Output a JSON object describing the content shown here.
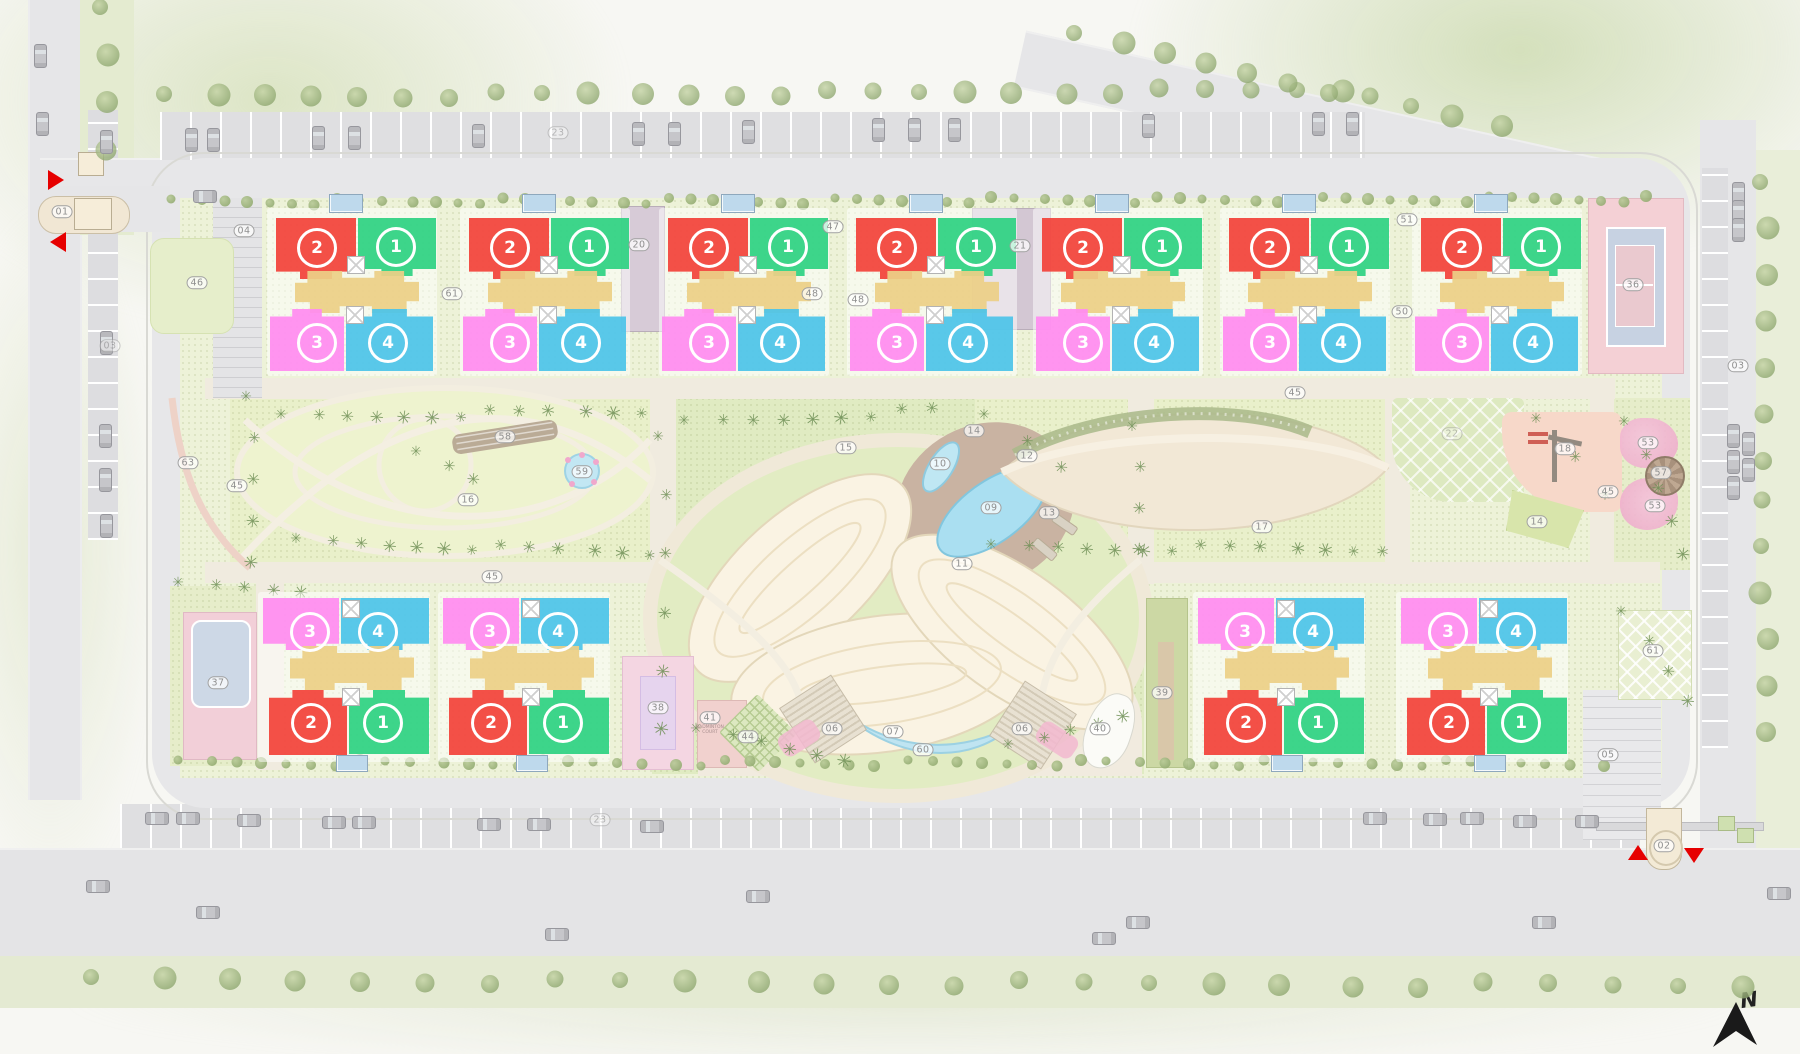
{
  "north": {
    "label": "N"
  },
  "units": {
    "u1": {
      "num": "1",
      "color": "#2ed282"
    },
    "u2": {
      "num": "2",
      "color": "#f2433a"
    },
    "u3": {
      "num": "3",
      "color": "#ff8cf0"
    },
    "u4": {
      "num": "4",
      "color": "#4cc4e8"
    }
  },
  "palette": {
    "tan": "#ecd086",
    "arrow_red": "#e60000"
  },
  "top_clusters": [
    {
      "cx": 317
    },
    {
      "cx": 510
    },
    {
      "cx": 709
    },
    {
      "cx": 897
    },
    {
      "cx": 1083
    },
    {
      "cx": 1270
    },
    {
      "cx": 1462
    }
  ],
  "bottom_clusters": [
    {
      "cx": 310
    },
    {
      "cx": 490
    },
    {
      "cx": 1245
    },
    {
      "cx": 1448
    }
  ],
  "labels": [
    {
      "t": "01",
      "x": 62,
      "y": 212
    },
    {
      "t": "02",
      "x": 1664,
      "y": 846
    },
    {
      "t": "03",
      "x": 110,
      "y": 346,
      "faint": true
    },
    {
      "t": "03",
      "x": 1738,
      "y": 366
    },
    {
      "t": "04",
      "x": 244,
      "y": 231
    },
    {
      "t": "05",
      "x": 1608,
      "y": 755
    },
    {
      "t": "06",
      "x": 832,
      "y": 729
    },
    {
      "t": "06",
      "x": 1022,
      "y": 729
    },
    {
      "t": "07",
      "x": 893,
      "y": 732
    },
    {
      "t": "09",
      "x": 991,
      "y": 508
    },
    {
      "t": "10",
      "x": 940,
      "y": 464
    },
    {
      "t": "11",
      "x": 962,
      "y": 564
    },
    {
      "t": "12",
      "x": 1027,
      "y": 456
    },
    {
      "t": "13",
      "x": 1049,
      "y": 513
    },
    {
      "t": "14",
      "x": 974,
      "y": 431
    },
    {
      "t": "14",
      "x": 1537,
      "y": 522
    },
    {
      "t": "15",
      "x": 846,
      "y": 448
    },
    {
      "t": "16",
      "x": 468,
      "y": 500
    },
    {
      "t": "17",
      "x": 1262,
      "y": 527
    },
    {
      "t": "18",
      "x": 1565,
      "y": 449
    },
    {
      "t": "20",
      "x": 639,
      "y": 245
    },
    {
      "t": "21",
      "x": 1020,
      "y": 246
    },
    {
      "t": "22",
      "x": 1452,
      "y": 434,
      "faint": true
    },
    {
      "t": "23",
      "x": 558,
      "y": 133,
      "faint": true
    },
    {
      "t": "23",
      "x": 600,
      "y": 820,
      "faint": true
    },
    {
      "t": "36",
      "x": 1633,
      "y": 285
    },
    {
      "t": "37",
      "x": 218,
      "y": 683
    },
    {
      "t": "38",
      "x": 658,
      "y": 708
    },
    {
      "t": "39",
      "x": 1162,
      "y": 693
    },
    {
      "t": "40",
      "x": 1100,
      "y": 729
    },
    {
      "t": "41",
      "x": 710,
      "y": 718,
      "cap": "BADMINTON COURT"
    },
    {
      "t": "44",
      "x": 748,
      "y": 737
    },
    {
      "t": "45",
      "x": 237,
      "y": 486
    },
    {
      "t": "45",
      "x": 492,
      "y": 577
    },
    {
      "t": "45",
      "x": 1295,
      "y": 393
    },
    {
      "t": "45",
      "x": 1608,
      "y": 492
    },
    {
      "t": "46",
      "x": 197,
      "y": 283
    },
    {
      "t": "47",
      "x": 833,
      "y": 227
    },
    {
      "t": "48",
      "x": 812,
      "y": 294
    },
    {
      "t": "48",
      "x": 858,
      "y": 300
    },
    {
      "t": "50",
      "x": 1402,
      "y": 312
    },
    {
      "t": "51",
      "x": 1407,
      "y": 220
    },
    {
      "t": "53",
      "x": 1648,
      "y": 443
    },
    {
      "t": "53",
      "x": 1655,
      "y": 506
    },
    {
      "t": "57",
      "x": 1661,
      "y": 473
    },
    {
      "t": "58",
      "x": 505,
      "y": 437
    },
    {
      "t": "59",
      "x": 582,
      "y": 472
    },
    {
      "t": "60",
      "x": 923,
      "y": 750
    },
    {
      "t": "61",
      "x": 452,
      "y": 294
    },
    {
      "t": "61",
      "x": 1653,
      "y": 651
    },
    {
      "t": "63",
      "x": 188,
      "y": 463
    }
  ],
  "entrance_arrows": [
    {
      "dir": "right",
      "x": 48,
      "y": 170
    },
    {
      "dir": "left",
      "x": 50,
      "y": 232
    },
    {
      "dir": "up",
      "x": 1628,
      "y": 845
    },
    {
      "dir": "down",
      "x": 1684,
      "y": 848
    }
  ],
  "cars": [
    [
      185,
      128,
      "v"
    ],
    [
      207,
      128,
      "v"
    ],
    [
      312,
      126,
      "v"
    ],
    [
      348,
      126,
      "v"
    ],
    [
      472,
      124,
      "v"
    ],
    [
      632,
      122,
      "v"
    ],
    [
      668,
      122,
      "v"
    ],
    [
      742,
      120,
      "v"
    ],
    [
      872,
      118,
      "v"
    ],
    [
      908,
      118,
      "v"
    ],
    [
      948,
      118,
      "v"
    ],
    [
      1142,
      114,
      "v"
    ],
    [
      1312,
      112,
      "v"
    ],
    [
      1346,
      112,
      "v"
    ],
    [
      34,
      44,
      "v"
    ],
    [
      36,
      112,
      "v"
    ],
    [
      100,
      130,
      "v"
    ],
    [
      100,
      331,
      "v"
    ],
    [
      99,
      424,
      "v"
    ],
    [
      99,
      468,
      "v"
    ],
    [
      100,
      514,
      "v"
    ],
    [
      1732,
      182,
      "v"
    ],
    [
      1732,
      200,
      "v"
    ],
    [
      1732,
      218,
      "v"
    ],
    [
      1727,
      424,
      "v"
    ],
    [
      1727,
      450,
      "v"
    ],
    [
      1742,
      432,
      "v"
    ],
    [
      1742,
      458,
      "v"
    ],
    [
      1727,
      476,
      "v"
    ],
    [
      193,
      190,
      "h"
    ],
    [
      145,
      812,
      "h"
    ],
    [
      176,
      812,
      "h"
    ],
    [
      237,
      814,
      "h"
    ],
    [
      322,
      816,
      "h"
    ],
    [
      352,
      816,
      "h"
    ],
    [
      477,
      818,
      "h"
    ],
    [
      527,
      818,
      "h"
    ],
    [
      640,
      820,
      "h"
    ],
    [
      1363,
      812,
      "h"
    ],
    [
      1423,
      813,
      "h"
    ],
    [
      1460,
      812,
      "h"
    ],
    [
      1513,
      815,
      "h"
    ],
    [
      1575,
      815,
      "h"
    ],
    [
      1767,
      887,
      "h"
    ],
    [
      196,
      906,
      "h"
    ],
    [
      545,
      928,
      "h"
    ],
    [
      746,
      890,
      "h"
    ],
    [
      1092,
      932,
      "h"
    ],
    [
      1126,
      916,
      "h"
    ],
    [
      1532,
      916,
      "h"
    ],
    [
      86,
      880,
      "h"
    ]
  ],
  "vegetation_rows": [
    [
      175,
      202,
      1650,
      199,
      64,
      "bush"
    ],
    [
      182,
      763,
      1600,
      763,
      56,
      "bush"
    ],
    [
      95,
      980,
      1745,
      986,
      26,
      "tree"
    ],
    [
      168,
      97,
      1345,
      90,
      26,
      "tree"
    ],
    [
      1078,
      36,
      1498,
      126,
      11,
      "tree"
    ],
    [
      1764,
      185,
      1764,
      730,
      13,
      "tree"
    ],
    [
      104,
      10,
      104,
      150,
      4,
      "tree"
    ],
    [
      285,
      418,
      640,
      410,
      13,
      "palm"
    ],
    [
      300,
      542,
      648,
      552,
      13,
      "palm"
    ],
    [
      688,
      424,
      935,
      410,
      9,
      "palm"
    ],
    [
      700,
      732,
      845,
      758,
      6,
      "palm"
    ],
    [
      1012,
      748,
      1122,
      714,
      5,
      "palm"
    ],
    [
      995,
      548,
      1382,
      548,
      14,
      "palm"
    ],
    [
      988,
      418,
      1058,
      468,
      3,
      "palm"
    ],
    [
      1628,
      425,
      1682,
      552,
      5,
      "palm"
    ],
    [
      1540,
      422,
      1602,
      495,
      3,
      "palm"
    ],
    [
      182,
      586,
      300,
      590,
      5,
      "palm"
    ],
    [
      662,
      440,
      662,
      726,
      6,
      "palm"
    ],
    [
      1136,
      430,
      1136,
      548,
      4,
      "palm"
    ],
    [
      250,
      400,
      250,
      560,
      5,
      "palm"
    ],
    [
      420,
      455,
      470,
      480,
      3,
      "palm"
    ],
    [
      1625,
      615,
      1685,
      700,
      4,
      "palm"
    ]
  ]
}
